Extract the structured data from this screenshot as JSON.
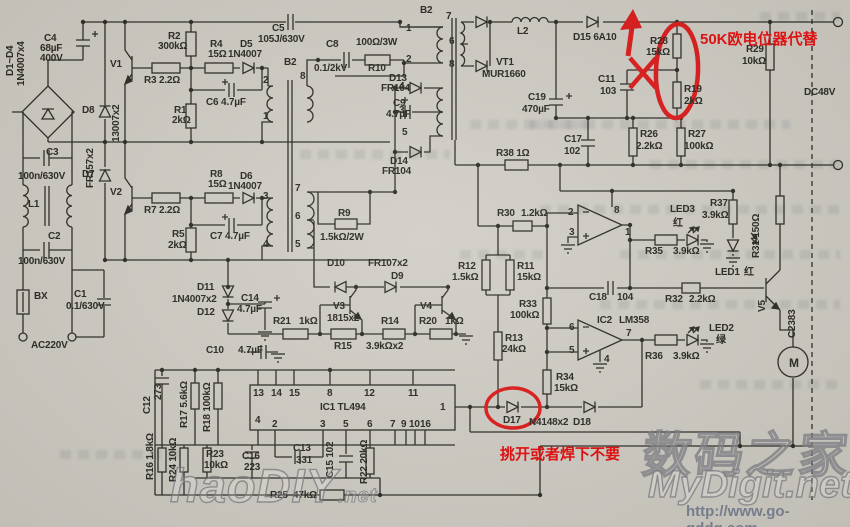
{
  "title": "TL494 switching power supply schematic (scan)",
  "colors": {
    "paper": "#cfccc4",
    "ink": "#26241f",
    "annotation_red": "#dd1212",
    "watermark_gray": "#757c8c"
  },
  "annotations": {
    "replace_pot": "50K欧电位器代替",
    "remove_diode": "挑开或者焊下不要"
  },
  "watermarks": {
    "haodiy": "haoDIY",
    "haodiy_tld": ".net",
    "digit_cn": "数码之家",
    "mydigit": "MyDigit.net",
    "url": "http://www.go-gddq.com"
  },
  "schematic": {
    "labels": [
      {
        "t": "D1~D4",
        "x": 6,
        "y": 76,
        "r": 1
      },
      {
        "t": "1N4007x4",
        "x": 17,
        "y": 86,
        "r": 1
      },
      {
        "t": "C4",
        "x": 44,
        "y": 34
      },
      {
        "t": "68µF",
        "x": 40,
        "y": 44
      },
      {
        "t": "400V",
        "x": 40,
        "y": 54
      },
      {
        "t": "V1",
        "x": 110,
        "y": 60
      },
      {
        "t": "R2",
        "x": 168,
        "y": 32
      },
      {
        "t": "300kΩ",
        "x": 158,
        "y": 42
      },
      {
        "t": "R3 2.2Ω",
        "x": 144,
        "y": 76
      },
      {
        "t": "R4",
        "x": 210,
        "y": 40
      },
      {
        "t": "15Ω",
        "x": 208,
        "y": 50
      },
      {
        "t": "D5",
        "x": 240,
        "y": 40
      },
      {
        "t": "1N4007",
        "x": 228,
        "y": 50
      },
      {
        "t": "C5",
        "x": 272,
        "y": 24
      },
      {
        "t": "105J/630V",
        "x": 258,
        "y": 35
      },
      {
        "t": "R1",
        "x": 174,
        "y": 106
      },
      {
        "t": "2kΩ",
        "x": 172,
        "y": 116
      },
      {
        "t": "C6 4.7µF",
        "x": 206,
        "y": 98
      },
      {
        "t": "D8",
        "x": 82,
        "y": 106
      },
      {
        "t": "FR157x2",
        "x": 86,
        "y": 188,
        "r": 1
      },
      {
        "t": "13007x2",
        "x": 112,
        "y": 142,
        "r": 1
      },
      {
        "t": "D7",
        "x": 82,
        "y": 170
      },
      {
        "t": "B2",
        "x": 284,
        "y": 58
      },
      {
        "t": "2",
        "x": 263,
        "y": 76
      },
      {
        "t": "8",
        "x": 300,
        "y": 72
      },
      {
        "t": "1",
        "x": 263,
        "y": 112
      },
      {
        "t": "3",
        "x": 263,
        "y": 192
      },
      {
        "t": "7",
        "x": 295,
        "y": 184
      },
      {
        "t": "6",
        "x": 295,
        "y": 212
      },
      {
        "t": "5",
        "x": 295,
        "y": 240
      },
      {
        "t": "4",
        "x": 263,
        "y": 240
      },
      {
        "t": "C8",
        "x": 326,
        "y": 40
      },
      {
        "t": "100Ω/3W",
        "x": 356,
        "y": 38
      },
      {
        "t": "0.1/2kV",
        "x": 314,
        "y": 64
      },
      {
        "t": "R10",
        "x": 368,
        "y": 64
      },
      {
        "t": "V2",
        "x": 110,
        "y": 188
      },
      {
        "t": "R7 2.2Ω",
        "x": 144,
        "y": 206
      },
      {
        "t": "R8",
        "x": 210,
        "y": 170
      },
      {
        "t": "15Ω",
        "x": 208,
        "y": 180
      },
      {
        "t": "D6",
        "x": 240,
        "y": 172
      },
      {
        "t": "1N4007",
        "x": 228,
        "y": 182
      },
      {
        "t": "C7 4.7µF",
        "x": 210,
        "y": 232
      },
      {
        "t": "R5",
        "x": 172,
        "y": 230
      },
      {
        "t": "2kΩ",
        "x": 168,
        "y": 241
      },
      {
        "t": "C3",
        "x": 46,
        "y": 148
      },
      {
        "t": "100n/630V",
        "x": 18,
        "y": 172
      },
      {
        "t": "L1",
        "x": 28,
        "y": 200
      },
      {
        "t": "C2",
        "x": 48,
        "y": 232
      },
      {
        "t": "100n/630V",
        "x": 18,
        "y": 257
      },
      {
        "t": "BX",
        "x": 34,
        "y": 292
      },
      {
        "t": "C1",
        "x": 74,
        "y": 290
      },
      {
        "t": "0.1/630V",
        "x": 66,
        "y": 302
      },
      {
        "t": "AC220V",
        "x": 31,
        "y": 341
      },
      {
        "t": "B2",
        "x": 420,
        "y": 6
      },
      {
        "t": "7",
        "x": 446,
        "y": 12
      },
      {
        "t": "1",
        "x": 406,
        "y": 24
      },
      {
        "t": "6",
        "x": 449,
        "y": 37
      },
      {
        "t": "2",
        "x": 406,
        "y": 55
      },
      {
        "t": "8",
        "x": 449,
        "y": 60
      },
      {
        "t": "4",
        "x": 399,
        "y": 82
      },
      {
        "t": "3",
        "x": 399,
        "y": 106
      },
      {
        "t": "5",
        "x": 402,
        "y": 128
      },
      {
        "t": "D13",
        "x": 389,
        "y": 74
      },
      {
        "t": "FR104",
        "x": 381,
        "y": 84
      },
      {
        "t": "C9",
        "x": 393,
        "y": 99
      },
      {
        "t": "4.7µF",
        "x": 386,
        "y": 110
      },
      {
        "t": "D14",
        "x": 390,
        "y": 157
      },
      {
        "t": "FR104",
        "x": 382,
        "y": 167
      },
      {
        "t": "VT1",
        "x": 496,
        "y": 58
      },
      {
        "t": "MUR1660",
        "x": 482,
        "y": 70
      },
      {
        "t": "L2",
        "x": 517,
        "y": 27
      },
      {
        "t": "C19",
        "x": 528,
        "y": 93
      },
      {
        "t": "470µF",
        "x": 522,
        "y": 105
      },
      {
        "t": "R38 1Ω",
        "x": 496,
        "y": 149
      },
      {
        "t": "D15 6A10",
        "x": 573,
        "y": 33
      },
      {
        "t": "R28",
        "x": 650,
        "y": 37
      },
      {
        "t": "15kΩ",
        "x": 646,
        "y": 48
      },
      {
        "t": "R19",
        "x": 684,
        "y": 85
      },
      {
        "t": "2kΩ",
        "x": 684,
        "y": 97
      },
      {
        "t": "C11",
        "x": 598,
        "y": 75
      },
      {
        "t": "103",
        "x": 600,
        "y": 87
      },
      {
        "t": "R29",
        "x": 746,
        "y": 45
      },
      {
        "t": "10kΩ",
        "x": 742,
        "y": 57
      },
      {
        "t": "DC48V",
        "x": 804,
        "y": 88
      },
      {
        "t": "C17",
        "x": 564,
        "y": 135
      },
      {
        "t": "102",
        "x": 564,
        "y": 147
      },
      {
        "t": "R26",
        "x": 640,
        "y": 130
      },
      {
        "t": "2.2kΩ",
        "x": 636,
        "y": 142
      },
      {
        "t": "R27",
        "x": 688,
        "y": 130
      },
      {
        "t": "100kΩ",
        "x": 684,
        "y": 142
      },
      {
        "t": "R30",
        "x": 497,
        "y": 209
      },
      {
        "t": "1.2kΩ",
        "x": 521,
        "y": 209
      },
      {
        "t": "R12",
        "x": 458,
        "y": 262
      },
      {
        "t": "1.5kΩ",
        "x": 452,
        "y": 273
      },
      {
        "t": "R11",
        "x": 517,
        "y": 262
      },
      {
        "t": "15kΩ",
        "x": 517,
        "y": 273
      },
      {
        "t": "R33",
        "x": 519,
        "y": 300
      },
      {
        "t": "100kΩ",
        "x": 510,
        "y": 311
      },
      {
        "t": "R13",
        "x": 505,
        "y": 334
      },
      {
        "t": "24kΩ",
        "x": 502,
        "y": 345
      },
      {
        "t": "R34",
        "x": 556,
        "y": 373
      },
      {
        "t": "15kΩ",
        "x": 554,
        "y": 384
      },
      {
        "t": "R9",
        "x": 338,
        "y": 209
      },
      {
        "t": "1.5kΩ/2W",
        "x": 320,
        "y": 233
      },
      {
        "t": "D10",
        "x": 327,
        "y": 259
      },
      {
        "t": "FR107x2",
        "x": 368,
        "y": 259
      },
      {
        "t": "D9",
        "x": 391,
        "y": 272
      },
      {
        "t": "V3",
        "x": 333,
        "y": 302
      },
      {
        "t": "1815x2",
        "x": 327,
        "y": 314
      },
      {
        "t": "V4",
        "x": 420,
        "y": 302
      },
      {
        "t": "R21",
        "x": 273,
        "y": 317
      },
      {
        "t": "1kΩ",
        "x": 299,
        "y": 317
      },
      {
        "t": "R15",
        "x": 334,
        "y": 342
      },
      {
        "t": "R14",
        "x": 381,
        "y": 317
      },
      {
        "t": "3.9kΩx2",
        "x": 366,
        "y": 342
      },
      {
        "t": "R20",
        "x": 419,
        "y": 317
      },
      {
        "t": "1kΩ",
        "x": 445,
        "y": 317
      },
      {
        "t": "C14",
        "x": 241,
        "y": 294
      },
      {
        "t": "4.7µF",
        "x": 237,
        "y": 305
      },
      {
        "t": "D11",
        "x": 197,
        "y": 283
      },
      {
        "t": "1N4007x2",
        "x": 172,
        "y": 295
      },
      {
        "t": "D12",
        "x": 197,
        "y": 308
      },
      {
        "t": "C10",
        "x": 206,
        "y": 346
      },
      {
        "t": "4.7µF",
        "x": 238,
        "y": 346
      },
      {
        "t": "C12",
        "x": 143,
        "y": 414,
        "r": 1
      },
      {
        "t": "273",
        "x": 154,
        "y": 400,
        "r": 1
      },
      {
        "t": "R17 5.6kΩ",
        "x": 180,
        "y": 428,
        "r": 1
      },
      {
        "t": "R18 100kΩ",
        "x": 203,
        "y": 432,
        "r": 1
      },
      {
        "t": "R16 1.8kΩ",
        "x": 146,
        "y": 480,
        "r": 1
      },
      {
        "t": "R24 10kΩ",
        "x": 169,
        "y": 482,
        "r": 1
      },
      {
        "t": "R23",
        "x": 206,
        "y": 450
      },
      {
        "t": "10kΩ",
        "x": 204,
        "y": 461
      },
      {
        "t": "C16",
        "x": 242,
        "y": 452
      },
      {
        "t": "223",
        "x": 244,
        "y": 463
      },
      {
        "t": "C13",
        "x": 293,
        "y": 444
      },
      {
        "t": "331",
        "x": 296,
        "y": 456
      },
      {
        "t": "C15 102",
        "x": 326,
        "y": 478,
        "r": 1
      },
      {
        "t": "R22 20kΩ",
        "x": 360,
        "y": 484,
        "r": 1
      },
      {
        "t": "R25",
        "x": 270,
        "y": 491
      },
      {
        "t": "47kΩ",
        "x": 293,
        "y": 491
      },
      {
        "t": "IC1 TL494",
        "x": 320,
        "y": 403
      },
      {
        "t": "13",
        "x": 253,
        "y": 389
      },
      {
        "t": "14",
        "x": 271,
        "y": 389
      },
      {
        "t": "15",
        "x": 289,
        "y": 389
      },
      {
        "t": "8",
        "x": 327,
        "y": 389
      },
      {
        "t": "12",
        "x": 364,
        "y": 389
      },
      {
        "t": "11",
        "x": 408,
        "y": 389
      },
      {
        "t": "4",
        "x": 255,
        "y": 416
      },
      {
        "t": "2",
        "x": 272,
        "y": 420
      },
      {
        "t": "3",
        "x": 320,
        "y": 420
      },
      {
        "t": "5",
        "x": 343,
        "y": 420
      },
      {
        "t": "6",
        "x": 367,
        "y": 420
      },
      {
        "t": "7",
        "x": 390,
        "y": 420
      },
      {
        "t": "9",
        "x": 401,
        "y": 420
      },
      {
        "t": "10",
        "x": 409,
        "y": 420
      },
      {
        "t": "16",
        "x": 420,
        "y": 420
      },
      {
        "t": "1",
        "x": 440,
        "y": 403
      },
      {
        "t": "D17",
        "x": 503,
        "y": 416
      },
      {
        "t": "N4148x2",
        "x": 529,
        "y": 418
      },
      {
        "t": "D18",
        "x": 573,
        "y": 418
      },
      {
        "t": "2",
        "x": 568,
        "y": 208
      },
      {
        "t": "3",
        "x": 569,
        "y": 228
      },
      {
        "t": "8",
        "x": 614,
        "y": 206
      },
      {
        "t": "1",
        "x": 625,
        "y": 228
      },
      {
        "t": "IC2",
        "x": 597,
        "y": 316
      },
      {
        "t": "LM358",
        "x": 619,
        "y": 316
      },
      {
        "t": "6",
        "x": 569,
        "y": 323
      },
      {
        "t": "5",
        "x": 569,
        "y": 346
      },
      {
        "t": "7",
        "x": 626,
        "y": 329
      },
      {
        "t": "4",
        "x": 604,
        "y": 355
      },
      {
        "t": "C18",
        "x": 589,
        "y": 293
      },
      {
        "t": "104",
        "x": 617,
        "y": 293
      },
      {
        "t": "R32",
        "x": 665,
        "y": 295
      },
      {
        "t": "2.2kΩ",
        "x": 689,
        "y": 295
      },
      {
        "t": "R35",
        "x": 645,
        "y": 247
      },
      {
        "t": "3.9kΩ",
        "x": 673,
        "y": 247
      },
      {
        "t": "LED3",
        "x": 670,
        "y": 205
      },
      {
        "t": "红",
        "x": 673,
        "y": 219
      },
      {
        "t": "R37",
        "x": 710,
        "y": 199
      },
      {
        "t": "3.9kΩ",
        "x": 702,
        "y": 211
      },
      {
        "t": "LED1",
        "x": 715,
        "y": 268
      },
      {
        "t": "红",
        "x": 744,
        "y": 268
      },
      {
        "t": "R36",
        "x": 645,
        "y": 352
      },
      {
        "t": "3.9kΩ",
        "x": 673,
        "y": 352
      },
      {
        "t": "LED2",
        "x": 709,
        "y": 324
      },
      {
        "t": "绿",
        "x": 716,
        "y": 336
      },
      {
        "t": "R31 150Ω",
        "x": 752,
        "y": 258,
        "r": 1
      },
      {
        "t": "V5",
        "x": 758,
        "y": 312,
        "r": 1
      },
      {
        "t": "C2383",
        "x": 788,
        "y": 338,
        "r": 1
      },
      {
        "t": "M",
        "x": 789,
        "y": 357,
        "s": 12
      }
    ]
  }
}
